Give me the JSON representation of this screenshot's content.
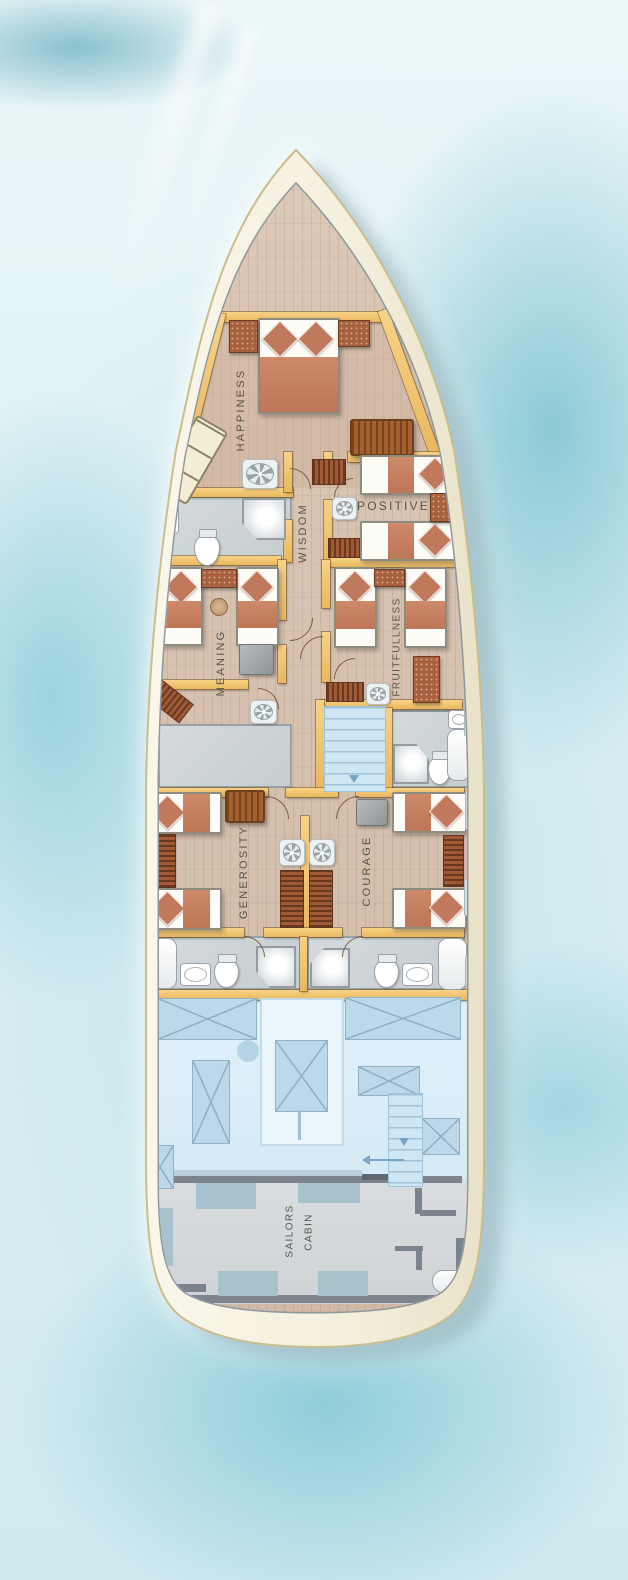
{
  "title": "Yacht lower deck floor plan",
  "labels": {
    "happiness": "HAPPINESS",
    "positive": "POSITIVE",
    "wisdom": "WISDOM",
    "meaning": "MEANING",
    "fruitfullness": "FRUITFULLNESS",
    "generosity": "GENEROSITY",
    "courage": "COURAGE",
    "sailors_line1": "SAILORS",
    "sailors_line2": "CABIN"
  },
  "colors": {
    "water": "#bfe2ea",
    "hull": "#f6f1e1",
    "deck_wood": "#d8c3b2",
    "wall": "#f1c36a",
    "bed_blanket": "#c3805f",
    "pillow": "#c0795c",
    "bathroom_floor": "#ccd2d6",
    "engine_room": "#dcedf8",
    "sailors_floor": "#d6d9db",
    "stairs": "#cfe7f5",
    "label_text": "#57534b"
  }
}
